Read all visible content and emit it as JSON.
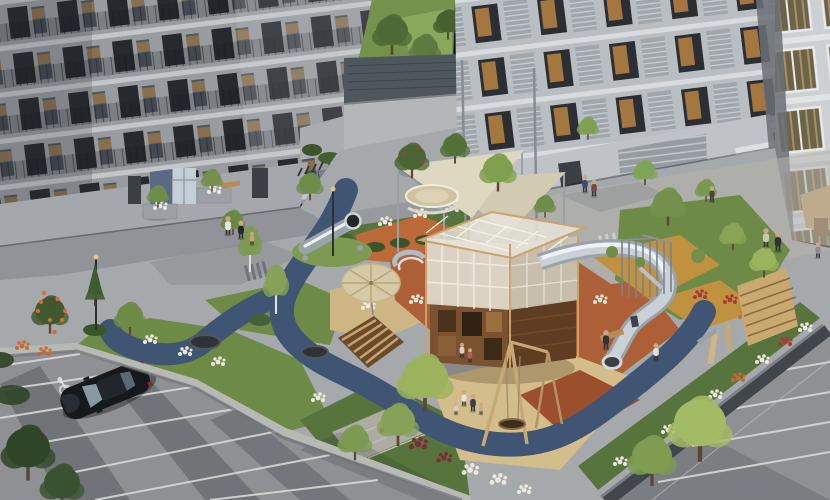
{
  "meta": {
    "alt": "Aerial dusk render of a residential courtyard: apartment blocks around a landscaped playground with wooden play tower, spiral tube slide, shade sails, nest swing, blue rubber path, lawns and flower beds; parking lot with a black car on an accessible space in the foreground."
  },
  "palette": {
    "facadeLeft": "#979ba0",
    "facadeRight": "#b9bec3",
    "facadeFar": "#ccd0d3",
    "parkGrass": "#74924c",
    "treeDark": "#46622f",
    "treeMid": "#6f8c49",
    "treeLight": "#9ab35c",
    "plaza": "#a6a9ac",
    "plazaWarm": "#b5b2ac",
    "lawn": "#6d8a47",
    "lawnDark": "#57743c",
    "pathBlue": "#3f5573",
    "rubberTerracotta": "#ad6038",
    "rubberRed": "#9c4f2c",
    "rubberOrange": "#bc6a3a",
    "rubberMustard": "#c0923f",
    "rubberSand": "#cdb684",
    "rubberBeige": "#d3bd8a",
    "asphalt": "#8e9094",
    "parkingLine": "#d8d8d4",
    "wallConcrete": "#b7b9b4",
    "podiumWall": "#41464d",
    "woodLight": "#c9a96f",
    "wood": "#b98a55",
    "woodDark": "#6a4a2c",
    "cubeWood": "#7a5230",
    "cubeWoodDark": "#5e3d22",
    "cubeMesh": "#ded9cc",
    "cubeMeshSide": "#c9c3b2",
    "steel": "#9aa2aa",
    "steelLight": "#c9d0d6",
    "steelHighlight": "#eef2f5",
    "sail": "#ded8c0",
    "sailDark": "#d2cbb2",
    "parasol": "#d6c9a6",
    "sand": "#cfc3a0",
    "carBody": "#15181c",
    "carGlass": "#8a98a4",
    "flowerWhite": "#eceade",
    "flowerRed": "#a83a3a",
    "flowerBurgundy": "#7a2f3a",
    "flowerOrange": "#c96a32",
    "skin": "#caa88a"
  },
  "objects": {
    "scene": "Residential courtyard aerial render at dusk",
    "building_left": "Apartment building, left block with balconies",
    "building_right": "Apartment building, right block with louvered panels",
    "building_far_right": "Apartment tower, far right with curtained windows",
    "park": "Park lawn with trees behind the courtyard",
    "garage_entrance": "Flat-roofed underground garage entrance",
    "plaza": "Paved pedestrian plaza",
    "courtyard": "Landscaped courtyard surfaces",
    "playground": "Children's playground",
    "play_tower": "Two-storey wooden play tower with mesh upper level",
    "tube_slide": "Stainless steel spiral tube slide",
    "hill_slide": "Embankment tube slide on green mound",
    "shade_sails": "Triangular fabric shade sails on masts",
    "sandpit": "Round sand play dish",
    "parasol": "Round timber parasol",
    "pergola": "Slatted timber pergola bench",
    "swing": "Timber A-frame nest swing",
    "climbing_wall": "Slatted timber climbing board",
    "climbing_frame": "Steel climbing poles",
    "trampolines": "In-ground trampolines on rubber path",
    "path_blue": "Dark blue rubber looping path",
    "lawn": "Courtyard lawns and hedges",
    "flower_beds": "White, red and burgundy flower beds",
    "parking": "Surface parking lot",
    "car": "Black car parked on accessible space",
    "accessible_marking": "Accessible parking wheelchair marking",
    "road": "Lower access road with markings",
    "retaining_wall": "Concrete retaining wall of the podium",
    "podium_edge": "Podium edge planter wall",
    "pedestrians": "Residents walking through the courtyard",
    "bench": "Wooden bench",
    "street_lamp": "Street lamp"
  }
}
